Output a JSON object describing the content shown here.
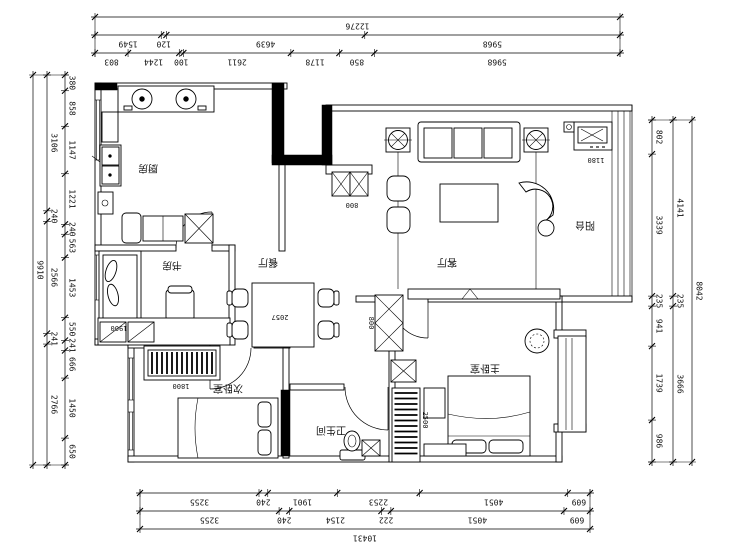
{
  "rooms": {
    "kitchen": "厨房",
    "study": "书房",
    "dining": "餐厅",
    "living": "客厅",
    "balcony": "阳台",
    "master_bedroom": "主卧室",
    "second_bedroom": "次卧室",
    "bathroom": "卫生间"
  },
  "inline_dims": {
    "shoe_cabinet": "800",
    "hall_column": "800",
    "desk_long": "2057",
    "desk_short": "1900",
    "tv_unit": "1180",
    "wardrobe_second": "1800",
    "wardrobe_master": "2500"
  },
  "dim_chains": {
    "top": {
      "total": "12276",
      "row_mid": [
        "1549",
        "120",
        "4639",
        "5968"
      ],
      "row_inner": [
        "803",
        "1244",
        "100",
        "2611",
        "1178",
        "850",
        "5968"
      ]
    },
    "bottom": {
      "total": "10431",
      "row_inner": [
        "3255",
        "240",
        "1901",
        "2253",
        "4051",
        "609"
      ],
      "row_mid": [
        "3255",
        "240",
        "2154",
        "222",
        "4051",
        "609"
      ]
    },
    "left": {
      "total": "9910",
      "row_mid": [
        "3106",
        "240",
        "2566",
        "241",
        "2766"
      ],
      "row_inner": [
        "380",
        "858",
        "1147",
        "1221",
        "240",
        "563",
        "1453",
        "550",
        "241",
        "666",
        "1450",
        "650"
      ]
    },
    "right": {
      "total": "8042",
      "row_inner": [
        "802",
        "3339",
        "235",
        "941",
        "1739",
        "986"
      ],
      "row_mid": [
        "4141",
        "235",
        "3666"
      ]
    }
  },
  "colors": {
    "line": "#000000",
    "background": "#ffffff"
  }
}
